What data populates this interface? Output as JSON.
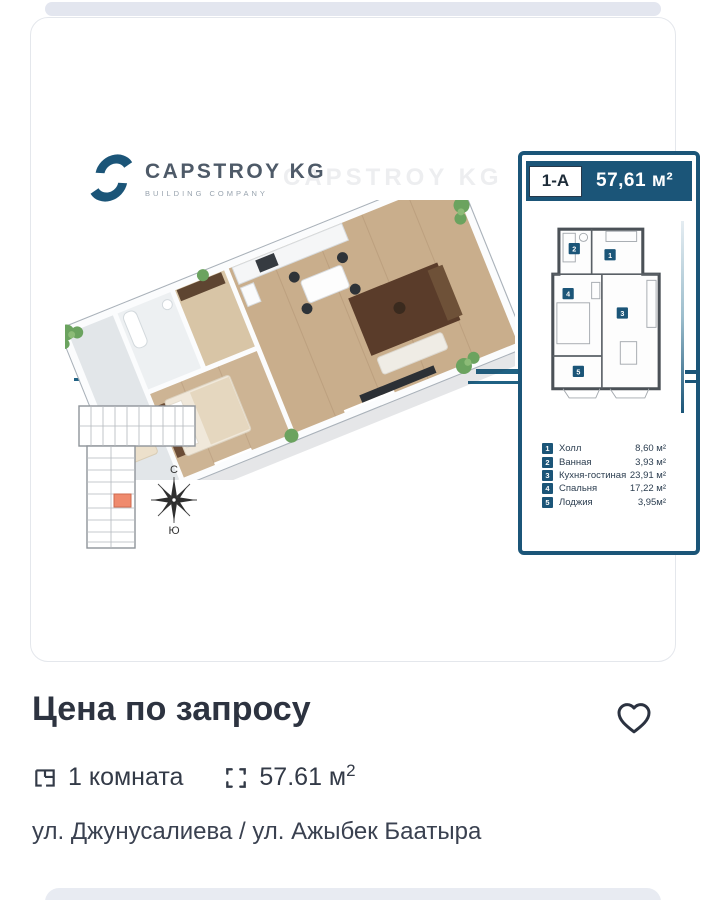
{
  "colors": {
    "accent": "#1b5578",
    "accent_line": "#1f6183",
    "highlight_unit": "#ef8a6d",
    "text_dark": "#2d3340",
    "text_body": "#3a4150"
  },
  "logo": {
    "title": "CAPSTROY KG",
    "subtitle": "BUILDING COMPANY",
    "watermark": "CAPSTROY KG"
  },
  "panel": {
    "unit": "1-А",
    "unit_area": "57,61 м²",
    "rooms": [
      {
        "num": "1",
        "label": "Холл",
        "area": "8,60 м²"
      },
      {
        "num": "2",
        "label": "Ванная",
        "area": "3,93 м²"
      },
      {
        "num": "3",
        "label": "Кухня-гостиная",
        "area": "23,91 м²"
      },
      {
        "num": "4",
        "label": "Спальня",
        "area": "17,22 м²"
      },
      {
        "num": "5",
        "label": "Лоджия",
        "area": "3,95м²"
      }
    ]
  },
  "compass": {
    "north": "С",
    "south": "Ю"
  },
  "listing": {
    "price": "Цена по запросу",
    "rooms_label": "1 комната",
    "area_value": "57.61 м",
    "area_sup": "2",
    "address": "ул. Джунусалиева / ул. Ажыбек Баатыра"
  },
  "icons": {
    "favorite": "heart-outline",
    "rooms": "floorplan-square",
    "area": "corner-brackets",
    "compass": "wind-rose"
  }
}
